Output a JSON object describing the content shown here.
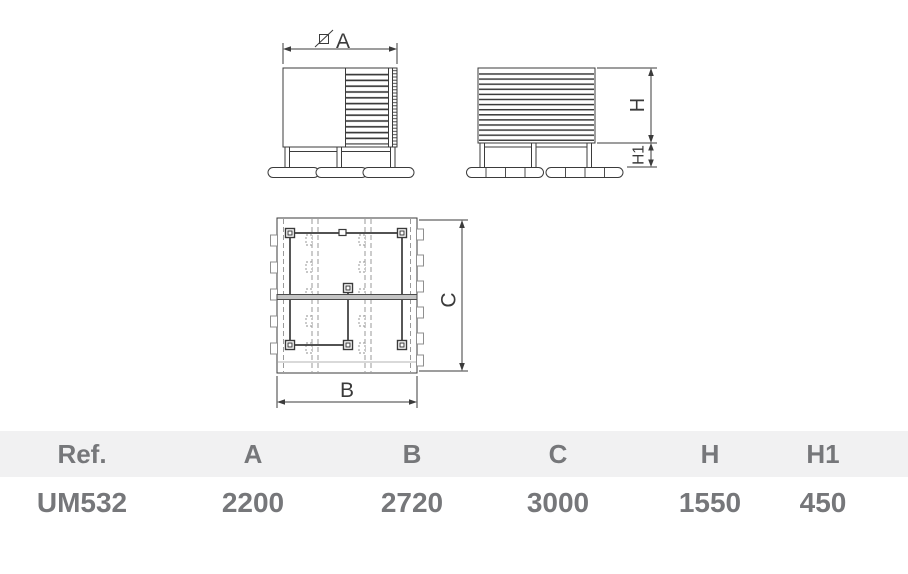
{
  "drawing": {
    "front_view": {
      "width_dim": "A"
    },
    "side_view": {
      "height_dim": "H",
      "base_height_dim": "H1"
    },
    "plan_view": {
      "width_dim": "B",
      "depth_dim": "C"
    }
  },
  "table": {
    "headers": [
      "Ref.",
      "A",
      "B",
      "C",
      "H",
      "H1"
    ],
    "row": [
      "UM532",
      "2200",
      "2720",
      "3000",
      "1550",
      "450"
    ]
  },
  "colors": {
    "line": "#3b3b3b",
    "dashed_line": "#8f8f8f",
    "table_header_bg": "#f1f1f2",
    "table_text": "#76777a"
  }
}
